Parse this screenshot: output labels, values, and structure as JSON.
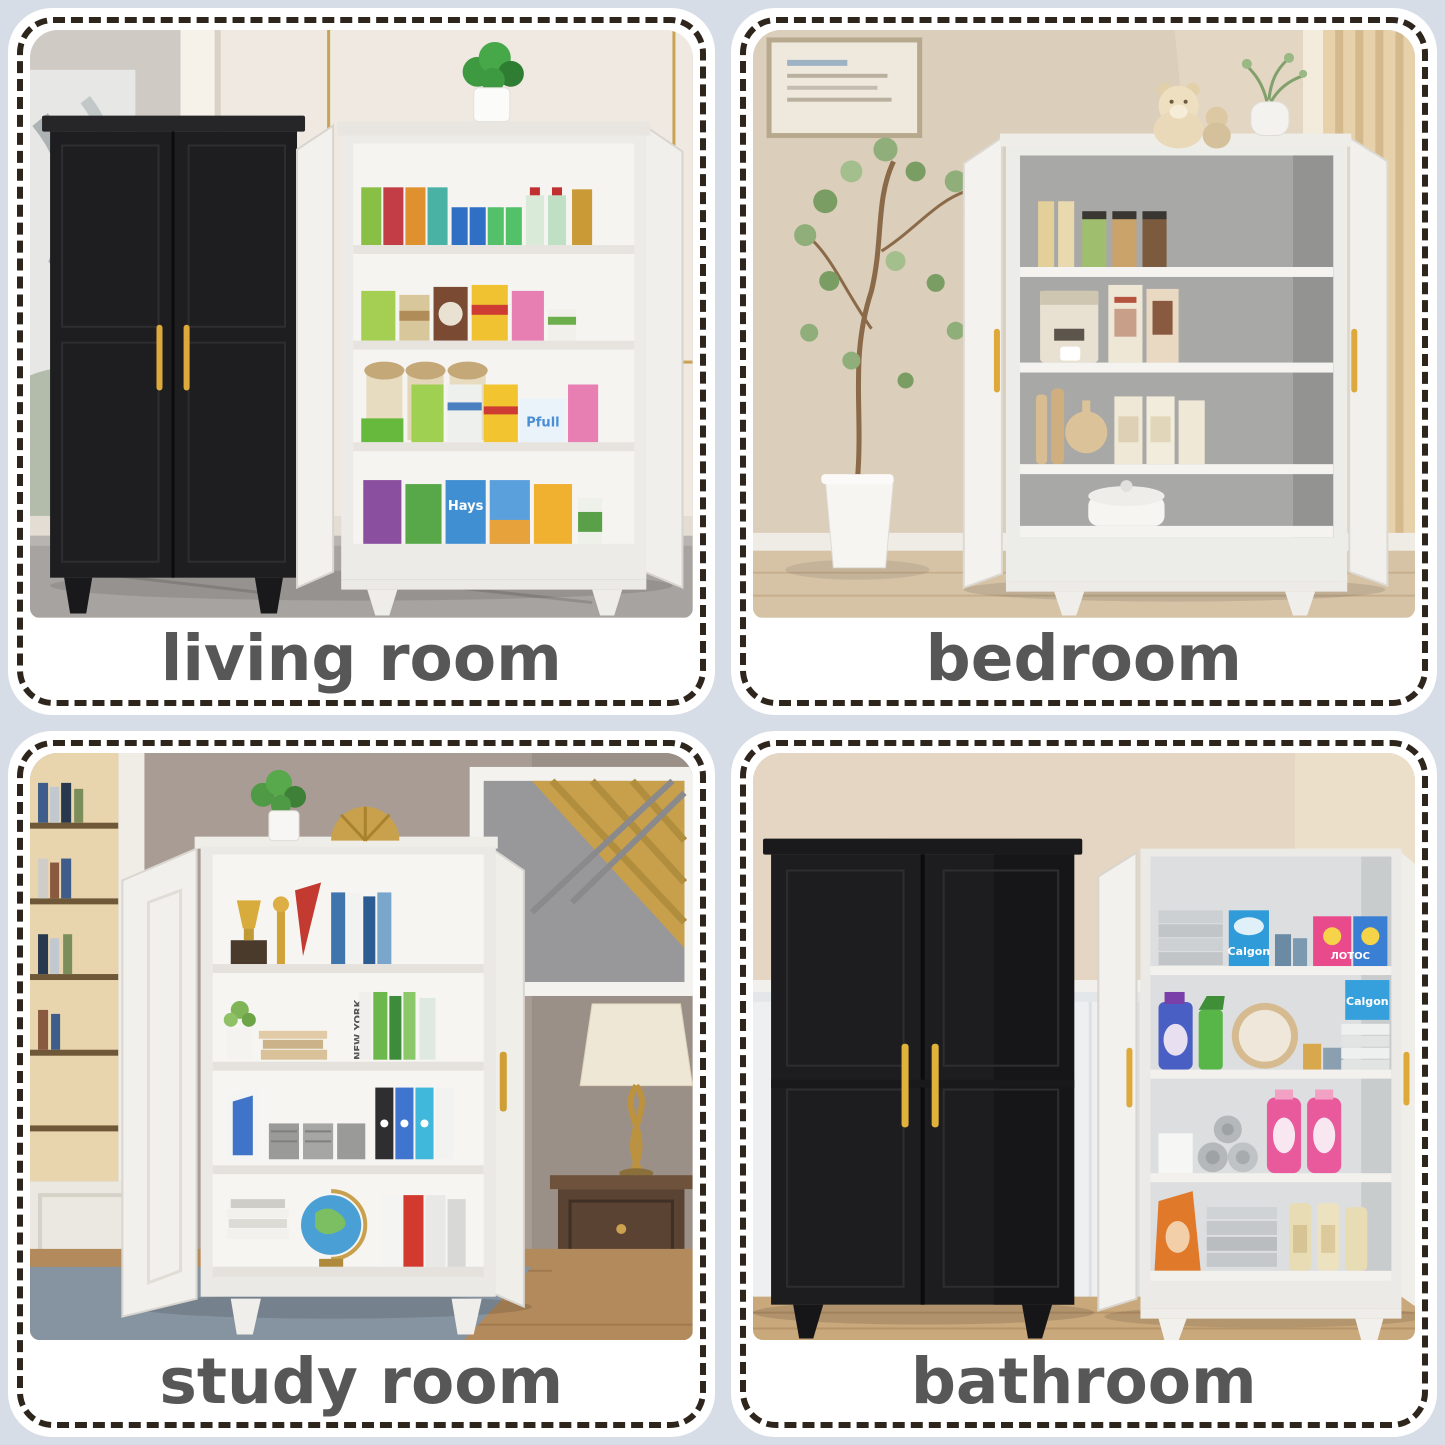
{
  "page": {
    "background_color": "#d7dde6",
    "card_background": "#ffffff",
    "dashed_border_color": "#2e251d",
    "caption_text_color": "#575757",
    "handle_gold": "#dca93a"
  },
  "cards": [
    {
      "label": "living room",
      "alt": "Black closed two-door cabinet beside a white open pantry cabinet with four shelves stocked with juice cartons, soda cans, chips and jars, plant on top, cream paneled wall with gold trim"
    },
    {
      "label": "bedroom",
      "alt": "White storage cabinet with both doors open showing jars, a coffee maker, cutting boards and canisters, teddy bear and vase on top, tall potted plant left, beige wall and curtain"
    },
    {
      "label": "study room",
      "alt": "White storage cabinet with open doors holding trophies, books, binders, file organizers and a globe, abstract gold art and lamp on a dark side table at right"
    },
    {
      "label": "bathroom",
      "alt": "Black closed cabinet beside a white open cabinet stocked with towels, detergent boxes and pink bottles, beige wall over white wainscoting"
    }
  ],
  "in_photo_text": {
    "calgon": "Calgon",
    "lotos": "ЛОТОС",
    "vanish": "Vanish",
    "hays": "Hays",
    "new_york": "NEW YORK",
    "pfull": "Pfull"
  }
}
